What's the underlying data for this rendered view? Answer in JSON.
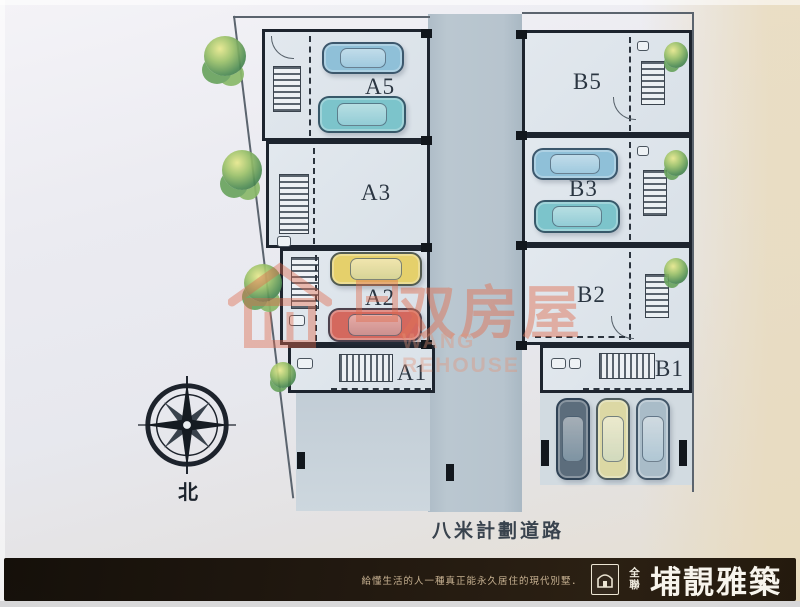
{
  "plan": {
    "units": [
      {
        "label": "A5"
      },
      {
        "label": "A3"
      },
      {
        "label": "A2"
      },
      {
        "label": "A1"
      },
      {
        "label": "B5"
      },
      {
        "label": "B3"
      },
      {
        "label": "B2"
      },
      {
        "label": "B1"
      }
    ],
    "road_label": "八米計劃道路",
    "compass_label": "北"
  },
  "watermark": {
    "cn": "双房屋",
    "en": "WANG REHOUSE"
  },
  "footer": {
    "slogan": "給懂生活的人一種真正能永久居住的現代別墅．",
    "logo_caption": "全聯",
    "brand": "埔靚雅築"
  },
  "colors": {
    "wall": "#1d242e",
    "road": "#b4c2cc",
    "unit_fill": "#dde4ea",
    "watermark_accent": "#e07054",
    "footer_bg": "#241a0e",
    "brand_text": "#f7f4ec",
    "car_blue": "#8fc0d8",
    "car_teal": "#7cc4cb",
    "car_yellow": "#e5d06b",
    "car_red": "#d4685e",
    "car_dark": "#5c6d7c",
    "car_pale": "#dcd8a4",
    "car_gray": "#a9bcc8",
    "tree_green": "#4e8c54"
  }
}
